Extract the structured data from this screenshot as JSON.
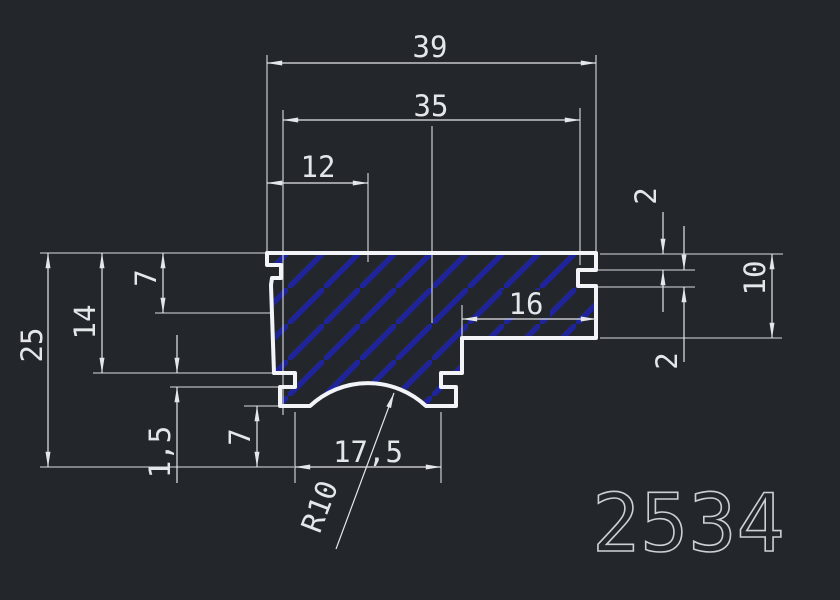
{
  "canvas": {
    "width": 840,
    "height": 600,
    "background": "#23262b"
  },
  "colors": {
    "line": "#e4e7ea",
    "profile_outline": "#f2f4f7",
    "hatch": "#20249a",
    "part_number_color": "#ccd0d5"
  },
  "drawing": {
    "part_number": "2534",
    "dimensions": {
      "total_width": "39",
      "upper_width": "35",
      "left_width": "12",
      "right_step_depth": "2",
      "right_groove_height": "2",
      "right_tab_height": "10",
      "total_height": "25",
      "height_to_groove": "14",
      "left_upper_depth": "7",
      "left_groove_height": "1,5",
      "foot_height": "7",
      "bottom_slot_width": "17,5",
      "slot_radius": "R10",
      "tab_width": "16"
    }
  }
}
